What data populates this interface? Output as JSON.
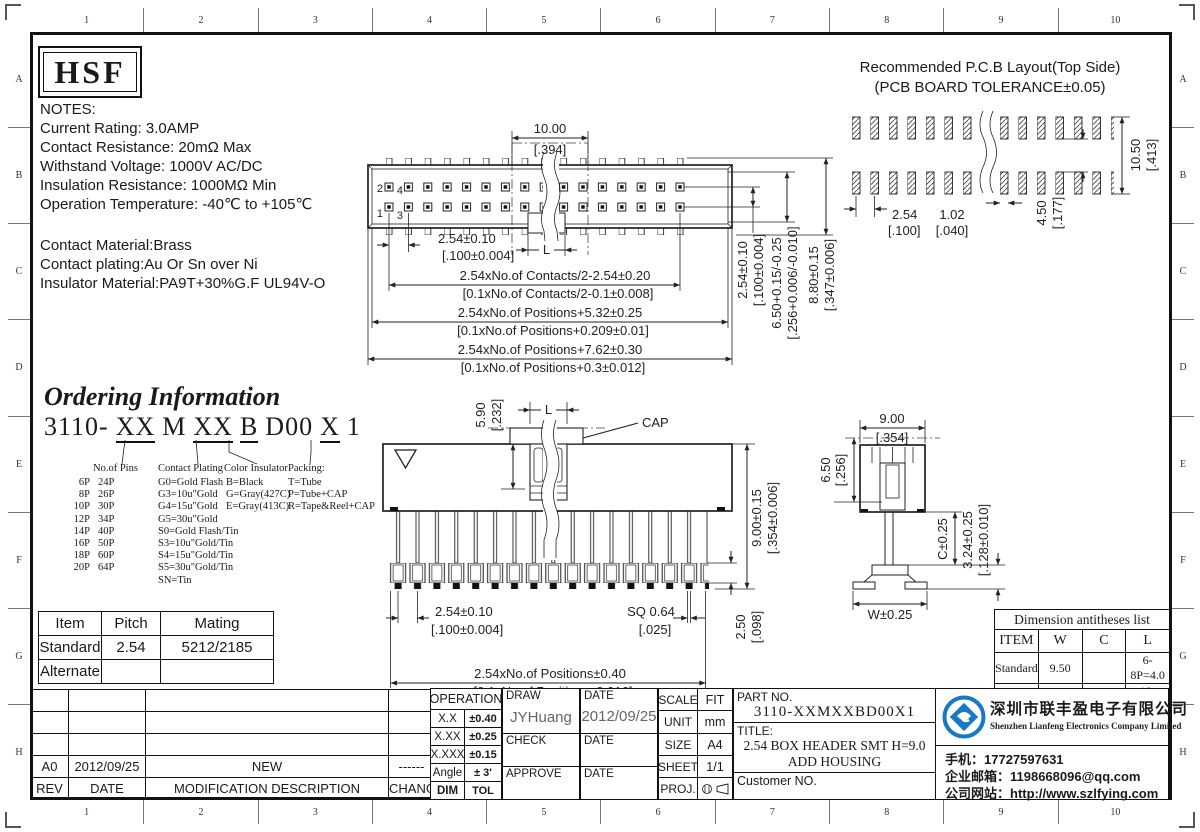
{
  "frame": {
    "cols": [
      "1",
      "2",
      "3",
      "4",
      "5",
      "6",
      "7",
      "8",
      "9",
      "10"
    ],
    "rows": [
      "A",
      "B",
      "C",
      "D",
      "E",
      "F",
      "G",
      "H"
    ]
  },
  "logo_text": "HSF",
  "notes": {
    "title": "NOTES:",
    "lines": [
      "Current Rating: 3.0AMP",
      "Contact Resistance: 20mΩ Max",
      "Withstand Voltage: 1000V AC/DC",
      "Insulation Resistance: 1000MΩ Min",
      "Operation Temperature: -40℃ to +105℃"
    ],
    "material": [
      "Contact Material:Brass",
      "Contact plating:Au Or Sn over Ni",
      "Insulator Material:PA9T+30%G.F UL94V-O"
    ]
  },
  "pcb": {
    "title1": "Recommended P.C.B Layout(Top Side)",
    "title2": "(PCB BOARD TOLERANCE±0.05)",
    "pitch": "2.54",
    "pitch_in": "[.100]",
    "pad_w": "1.02",
    "pad_w_in": "[.040]",
    "row_gap": "4.50",
    "row_gap_in": "[.177]",
    "total_h": "10.50",
    "total_h_in": "[.413]"
  },
  "top_view": {
    "cap_w": "10.00",
    "cap_w_in": "[.394]",
    "pin_1": "1",
    "pin_2": "2",
    "pin_3": "3",
    "pin_4": "4",
    "l_label": "L",
    "pitch": "2.54±0.10",
    "pitch_in": "[.100±0.004]",
    "contacts": "2.54xNo.of Contacts/2-2.54±0.20",
    "contacts_in": "[0.1xNo.of Contacts/2-0.1±0.008]",
    "positions1": "2.54xNo.of Positions+5.32±0.25",
    "positions1_in": "[0.1xNo.of Positions+0.209±0.01]",
    "positions2": "2.54xNo.of Positions+7.62±0.30",
    "positions2_in": "[0.1xNo.of Positions+0.3±0.012]",
    "row_pitch": "2.54±0.10",
    "row_pitch_in": "[.100±0.004]",
    "height1": "6.50+0.15/-0.25",
    "height1_in": "[.256+0.006/-0.010]",
    "height2": "8.80±0.15",
    "height2_in": "[.347±0.006]"
  },
  "ordering": {
    "title": "Ordering Information",
    "code": {
      "base": "3110-",
      "pins": "XX",
      "m": "M",
      "plating": "XX",
      "color": "B",
      "d": "D00",
      "pack": "X",
      "one": "1"
    },
    "pins_label": "No.of Pins",
    "pins_col1": [
      "6P",
      "8P",
      "10P",
      "12P",
      "14P",
      "16P",
      "18P",
      "20P"
    ],
    "pins_col2": [
      "24P",
      "26P",
      "30P",
      "34P",
      "40P",
      "50P",
      "60P",
      "64P"
    ],
    "plating_label": "Contact Plating",
    "plating": [
      "G0=Gold Flash",
      "G3=10u\"Gold",
      "G4=15u\"Gold",
      "G5=30u\"Gold",
      "S0=Gold Flash/Tin",
      "S3=10u\"Gold/Tin",
      "S4=15u\"Gold/Tin",
      "S5=30u\"Gold/Tin",
      "SN=Tin"
    ],
    "color_label": "Color Insulator",
    "colors": [
      "B=Black",
      "G=Gray(427C)",
      "E=Gray(413C)"
    ],
    "packing_label": "Packing:",
    "packing": [
      "T=Tube",
      "P=Tube+CAP",
      "R=Tape&Reel+CAP"
    ]
  },
  "front_view": {
    "cap_label": "CAP",
    "cap_h": "5.90",
    "cap_h_in": "[.232]",
    "l_label": "L",
    "height": "9.00±0.15",
    "height_in": "[.354±0.006]",
    "pitch": "2.54±0.10",
    "pitch_in": "[.100±0.004]",
    "sq": "SQ 0.64",
    "sq_in": "[.025]",
    "foot": "2.50",
    "foot_in": "[.098]",
    "total": "2.54xNo.of Positions±0.40",
    "total_in": "[0.1xNo.of Positions±0.016]"
  },
  "side_view": {
    "width": "9.00",
    "width_in": "[.354]",
    "depth": "6.50",
    "depth_in": "[.256]",
    "c": "C±0.25",
    "stub": "3.24±0.25",
    "stub_in": "[.128±0.010]",
    "foot_w": "W±0.25"
  },
  "mating_table": {
    "headers": [
      "Item",
      "Pitch",
      "Mating"
    ],
    "rows": [
      [
        "Standard",
        "2.54",
        "5212/2185"
      ],
      [
        "Alternate",
        "",
        ""
      ]
    ]
  },
  "dim_table": {
    "title": "Dimension antitheses list",
    "headers": [
      "ITEM",
      "W",
      "C",
      "L"
    ],
    "rows": [
      [
        "Standard",
        "9.50",
        "",
        "6-8P=4.0"
      ],
      [
        "Alternate",
        "",
        "",
        "10-64P=4.4"
      ]
    ]
  },
  "rev_table": {
    "entry": [
      "A0",
      "2012/09/25",
      "NEW",
      "------"
    ],
    "headers": [
      "REV",
      "DATE",
      "MODIFICATION DESCRIPTION",
      "CHANGE"
    ]
  },
  "title_block": {
    "operation_label": "OPERATION",
    "tolerances": [
      [
        "X.X",
        "±0.40"
      ],
      [
        "X.XX",
        "±0.25"
      ],
      [
        "X.XXX",
        "±0.15"
      ],
      [
        "Angle",
        "± 3'"
      ],
      [
        "DIM",
        "TOL"
      ]
    ],
    "draw_label": "DRAW",
    "draw_name": "JYHuang",
    "date_label": "DATE",
    "draw_date": "2012/09/25",
    "check_label": "CHECK",
    "approve_label": "APPROVE",
    "scale_label": "SCALE",
    "scale": "FIT",
    "unit_label": "UNIT",
    "unit": "mm",
    "size_label": "SIZE",
    "size": "A4",
    "sheet_label": "SHEET",
    "sheet": "1/1",
    "proj_label": "PROJ.",
    "part_no_label": "PART NO.",
    "part_no": "3110-XXMXXBD00X1",
    "title_label": "TITLE:",
    "title_line1": "2.54 BOX HEADER SMT H=9.0",
    "title_line2": "ADD HOUSING",
    "customer_label": "Customer NO."
  },
  "company": {
    "name_cn": "深圳市联丰盈电子有限公司",
    "name_en": "Shenzhen Lianfeng Electronics Company Limited",
    "phone": "手机：17727597631",
    "email": "企业邮箱：1198668096@qq.com",
    "website": "公司网站：http://www.szlfying.com",
    "logo_color": "#1679c8"
  }
}
